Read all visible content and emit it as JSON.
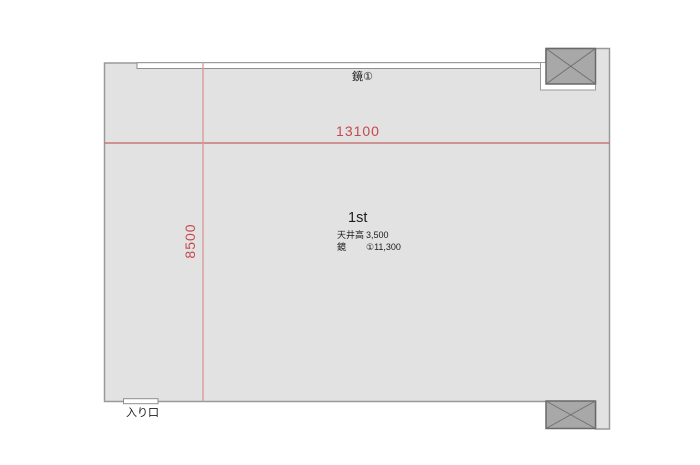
{
  "plan": {
    "room": {
      "name": "1st",
      "specs": [
        {
          "label": "天井高",
          "value": "3,500"
        },
        {
          "label": "鏡",
          "value": "①11,300"
        }
      ]
    },
    "dimensions": {
      "width_mm": "13100",
      "depth_mm": "8500"
    },
    "labels": {
      "mirror_top": "鏡①",
      "entrance": "入り口"
    },
    "colors": {
      "room_fill": "#e2e2e2",
      "room_outline": "#999999",
      "inner_outline": "#8f8f8f",
      "column_fill": "#a8a8a8",
      "column_outline": "#696969",
      "dim_text": "#c7484c",
      "dim_line_h": "#c36363",
      "dim_line_v": "#d89c9c",
      "text": "#1c1c1c",
      "white": "#ffffff"
    }
  }
}
